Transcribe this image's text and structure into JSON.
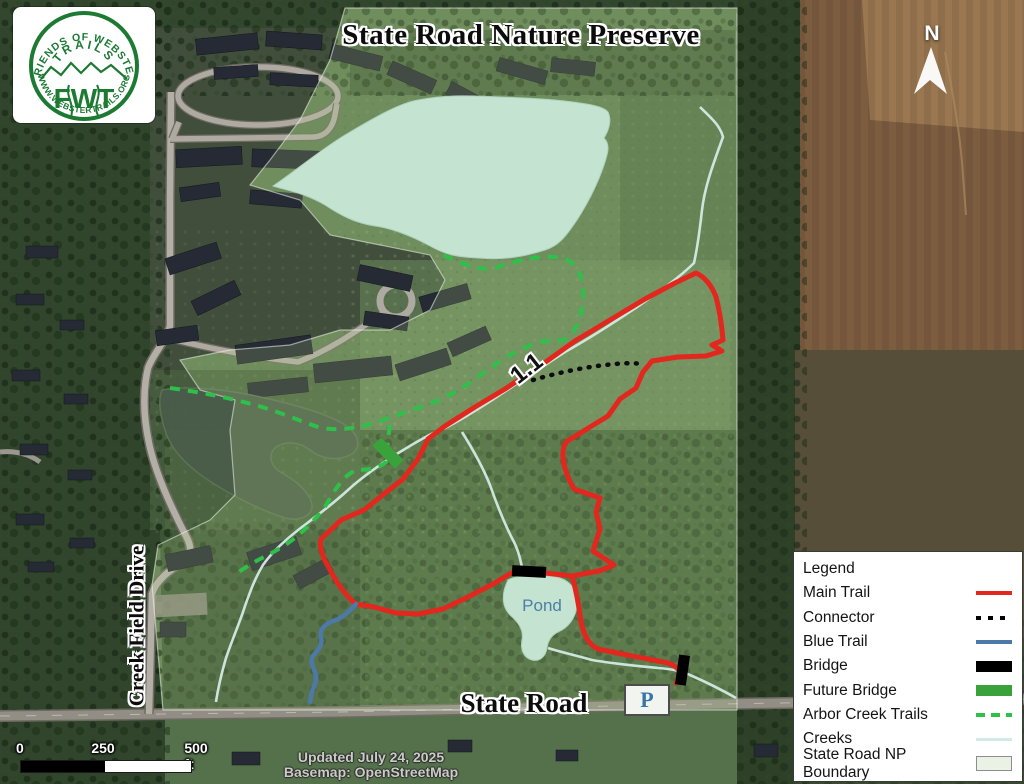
{
  "title": "State Road Nature Preserve",
  "logo": {
    "arc_top": "FRIENDS OF WEBSTER",
    "arc_mid": "TRAILS",
    "center": "FWT",
    "arc_bottom": "WWW.WEBSTERTRAILS.ORG"
  },
  "north": {
    "label": "N"
  },
  "labels": {
    "state_road": "State Road",
    "creek_field_drive": "Creek Field Drive",
    "pond": "Pond",
    "trail_distance": "1.1",
    "parking": "P"
  },
  "scale": {
    "tick0": "0",
    "tick1": "250",
    "tick2": "500 ft"
  },
  "attribution": {
    "updated": "Updated July 24, 2025",
    "basemap": "Basemap: OpenStreetMap"
  },
  "legend": {
    "header": "Legend",
    "items": [
      {
        "label": "Main Trail",
        "color": "#e2271e",
        "style": "solid line"
      },
      {
        "label": "Connector",
        "color": "#000000",
        "style": "dotted line"
      },
      {
        "label": "Blue Trail",
        "color": "#4c79a7",
        "style": "solid line"
      },
      {
        "label": "Bridge",
        "color": "#000000",
        "style": "thick bar"
      },
      {
        "label": "Future Bridge",
        "color": "#3aa23a",
        "style": "thick bar"
      },
      {
        "label": "Arbor Creek Trails",
        "color": "#2ec04a",
        "style": "dashed line"
      },
      {
        "label": "Creeks",
        "color": "#d2ebe4",
        "style": "thin line"
      },
      {
        "label": "State Road NP Boundary",
        "color": "#e9f2e4",
        "style": "filled area"
      }
    ]
  },
  "colors": {
    "main_trail": "#e2271e",
    "connector": "#000000",
    "blue_trail": "#4c79a7",
    "bridge": "#000000",
    "future_bridge": "#3aa23a",
    "arbor_creek_trails": "#2ec04a",
    "creeks": "#d2ebe4",
    "boundary_fill": "#e9f2e4",
    "lake": "#c7e7e2",
    "pond_label_text": "#4b80a8",
    "logo_green": "#1c7a33"
  }
}
